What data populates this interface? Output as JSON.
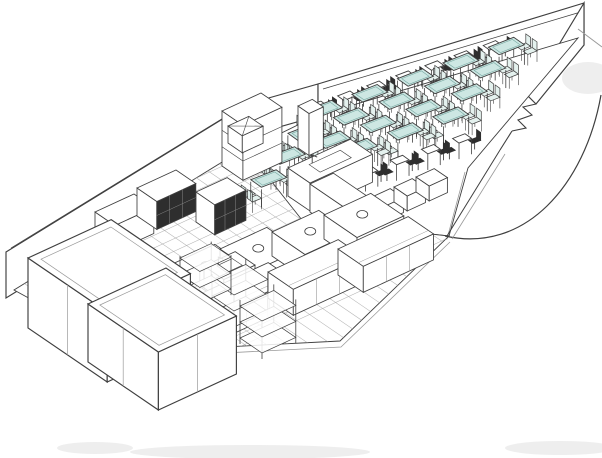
{
  "scene": {
    "canvas": {
      "w": 602,
      "h": 458,
      "bg": "#ffffff"
    },
    "style": {
      "line": "#3f3f3f",
      "lineLight": "#9a9a9a",
      "tile": "#a8a8a8",
      "wallFill": "#ffffff",
      "floorFill": "#ffffff",
      "tableTop": "#cde7e3",
      "tableTopEdge": "#78a8a2",
      "chairFill": "#e4f1ee",
      "darkFurniture": "#2e2e2e",
      "shadow": "#d9d9d9"
    },
    "walls": {
      "kitchenBack": {
        "face": [
          [
            6,
            252
          ],
          [
            247,
            104
          ],
          [
            247,
            150
          ],
          [
            6,
            298
          ]
        ],
        "topEdge": [
          [
            11,
            248
          ],
          [
            251,
            101
          ]
        ]
      },
      "capLine": [
        [
          247,
          104
        ],
        [
          247,
          150
        ]
      ],
      "step": {
        "face": [
          [
            258,
            101
          ],
          [
            318,
            84
          ],
          [
            318,
            116
          ],
          [
            258,
            133
          ]
        ]
      },
      "diningBack": {
        "face": [
          [
            318,
            84
          ],
          [
            584,
            3
          ],
          [
            584,
            45
          ],
          [
            318,
            126
          ]
        ],
        "topEdge": [
          [
            323,
            89
          ],
          [
            584,
            11
          ]
        ]
      },
      "rightUpper": {
        "face": [
          [
            584,
            3
          ],
          [
            584,
            45
          ],
          [
            536,
            104
          ],
          [
            528,
            96
          ]
        ]
      },
      "zigzag": [
        [
          536,
          104
        ],
        [
          523,
          107
        ],
        [
          532,
          115
        ],
        [
          518,
          120
        ],
        [
          526,
          128
        ],
        [
          512,
          131
        ]
      ],
      "doorStub": [
        [
          512,
          131
        ],
        [
          500,
          150
        ]
      ],
      "frontRight1": [
        [
          500,
          150
        ],
        [
          447,
          236
        ]
      ],
      "frontRight2": [
        [
          505,
          154
        ],
        [
          452,
          239
        ]
      ],
      "extTopRight": [
        [
          578,
          29
        ],
        [
          602,
          47
        ]
      ]
    },
    "floors": {
      "dining": [
        [
          316,
          116
        ],
        [
          578,
          38
        ],
        [
          468,
          168
        ],
        [
          449,
          236
        ],
        [
          302,
          221
        ],
        [
          247,
          150
        ]
      ],
      "diningEdgeInner": [
        [
          465,
          172
        ],
        [
          447,
          239
        ],
        [
          300,
          225
        ]
      ],
      "kitchen": [
        [
          245,
          148
        ],
        [
          302,
          220
        ],
        [
          449,
          236
        ],
        [
          340,
          341
        ],
        [
          127,
          352
        ],
        [
          14,
          290
        ]
      ],
      "kitchenBaseLine": [
        [
          127,
          358
        ],
        [
          341,
          347
        ],
        [
          450,
          242
        ]
      ],
      "tilesA": {
        "u": [
          26,
          -12
        ],
        "start": [
          230,
          150
        ],
        "step": [
          11,
          7.5
        ],
        "count": 17,
        "ext": 9.5
      },
      "tilesB": {
        "v": [
          22,
          15
        ],
        "start": [
          2,
          298
        ],
        "step": [
          13,
          -6
        ],
        "count": 36,
        "extNeg": 1.5,
        "extPos": 9
      }
    },
    "arc": {
      "d": "M 445 236 C 525 254, 585 185, 601 95"
    },
    "smudges": [
      {
        "cx": 588,
        "cy": 78,
        "rx": 26,
        "ry": 16
      },
      {
        "cx": 250,
        "cy": 452,
        "rx": 120,
        "ry": 7
      },
      {
        "cx": 560,
        "cy": 448,
        "rx": 55,
        "ry": 7
      },
      {
        "cx": 95,
        "cy": 448,
        "rx": 38,
        "ry": 6
      }
    ],
    "dining": {
      "origin": [
        316,
        116
      ],
      "grid": {
        "u": [
          26,
          -9
        ],
        "v": [
          -16,
          20
        ]
      },
      "item": {
        "u": [
          23,
          -9
        ],
        "v": [
          14,
          10
        ]
      },
      "tableSize": {
        "du": 0.55,
        "dv": 0.38,
        "h": 20
      },
      "chairOffsets": [
        [
          -0.82,
          -0.12
        ],
        [
          -0.82,
          0.34
        ],
        [
          0.82,
          -0.12
        ],
        [
          0.82,
          0.34
        ]
      ],
      "tables": [
        {
          "p": 1.0,
          "q": 1.1
        },
        {
          "p": 2.75,
          "q": 1.1
        },
        {
          "p": 4.5,
          "q": 1.1
        },
        {
          "p": 6.25,
          "q": 1.1
        },
        {
          "p": 8.0,
          "q": 1.1
        },
        {
          "p": 1.0,
          "q": 2.26
        },
        {
          "p": 2.75,
          "q": 2.26
        },
        {
          "p": 4.5,
          "q": 2.26
        },
        {
          "p": 6.25,
          "q": 2.26
        },
        {
          "p": 8.0,
          "q": 2.26
        },
        {
          "p": 1.0,
          "q": 3.42
        },
        {
          "p": 2.75,
          "q": 3.42
        },
        {
          "p": 4.5,
          "q": 3.42
        },
        {
          "p": 6.25,
          "q": 3.42
        },
        {
          "p": 8.0,
          "q": 3.42
        },
        {
          "p": 1.0,
          "q": 4.58
        },
        {
          "p": 2.75,
          "q": 4.58
        },
        {
          "p": 4.5,
          "q": 4.58
        },
        {
          "p": 6.25,
          "q": 4.58
        },
        {
          "p": 8.0,
          "q": 4.58
        }
      ],
      "wallTables": {
        "q": 0.45,
        "pStart": 0.35,
        "pStep": 1.12,
        "count": 7
      },
      "frontTables": {
        "q": 6.15,
        "pStart": 4.6,
        "pStep": 1.2,
        "count": 5
      }
    },
    "kitchen": {
      "basis": {
        "u": [
          26,
          -12
        ],
        "v": [
          22,
          15
        ]
      },
      "equipment": [
        {
          "t": "shelfbox",
          "a": [
            222,
            166
          ],
          "wu": 1.5,
          "wv": 0.95,
          "h": 55
        },
        {
          "t": "xcube",
          "a": [
            228,
            143
          ],
          "wu": 0.8,
          "wv": 0.65,
          "h": 17
        },
        {
          "t": "box",
          "a": [
            298,
            148
          ],
          "wu": 0.55,
          "wv": 0.5,
          "h": 42
        },
        {
          "t": "box",
          "a": [
            95,
            238
          ],
          "wu": 1.5,
          "wv": 0.9,
          "h": 26
        },
        {
          "t": "darkbox",
          "a": [
            137,
            216
          ],
          "wu": 1.5,
          "wv": 0.9,
          "h": 28
        },
        {
          "t": "darkbox",
          "a": [
            196,
            222
          ],
          "wu": 1.2,
          "wv": 0.85,
          "h": 30
        },
        {
          "t": "servL1",
          "a": [
            288,
            196
          ],
          "wu": 2.4,
          "wv": 1.0,
          "h": 28
        },
        {
          "t": "servL2",
          "a": [
            310,
            212
          ],
          "wu": 0.9,
          "wv": 1.9,
          "h": 28
        },
        {
          "t": "box",
          "a": [
            372,
            212
          ],
          "wu": 0.7,
          "wv": 0.6,
          "h": 15
        },
        {
          "t": "box",
          "a": [
            394,
            202
          ],
          "wu": 0.7,
          "wv": 0.6,
          "h": 15
        },
        {
          "t": "box",
          "a": [
            416,
            192
          ],
          "wu": 0.7,
          "wv": 0.6,
          "h": 15
        },
        {
          "t": "range",
          "a": [
            168,
            290
          ],
          "wu": 1.8,
          "wv": 1.5,
          "h": 24
        },
        {
          "t": "range",
          "a": [
            220,
            273
          ],
          "wu": 1.8,
          "wv": 1.5,
          "h": 24
        },
        {
          "t": "range",
          "a": [
            272,
            256
          ],
          "wu": 1.8,
          "wv": 1.5,
          "h": 24
        },
        {
          "t": "range",
          "a": [
            324,
            239
          ],
          "wu": 1.8,
          "wv": 1.5,
          "h": 24
        },
        {
          "t": "sink",
          "a": [
            92,
            286
          ],
          "wu": 1.3,
          "wv": 0.95,
          "h": 22
        },
        {
          "t": "sink",
          "a": [
            204,
            288
          ],
          "wu": 1.2,
          "wv": 0.9,
          "h": 22
        },
        {
          "t": "counter",
          "a": [
            128,
            344
          ],
          "wu": 2.7,
          "wv": 1.15,
          "h": 26
        },
        {
          "t": "counter",
          "a": [
            198,
            321
          ],
          "wu": 2.7,
          "wv": 1.15,
          "h": 26
        },
        {
          "t": "counter",
          "a": [
            268,
            298
          ],
          "wu": 2.7,
          "wv": 1.15,
          "h": 26
        },
        {
          "t": "counter",
          "a": [
            338,
            275
          ],
          "wu": 2.7,
          "wv": 1.15,
          "h": 26
        },
        {
          "t": "rack",
          "a": [
            212,
            318
          ],
          "wu": 1.3,
          "wv": 1.0,
          "h": 44
        },
        {
          "t": "rack",
          "a": [
            240,
            344
          ],
          "wu": 1.3,
          "wv": 1.0,
          "h": 44
        },
        {
          "t": "rack",
          "a": [
            180,
            296
          ],
          "wu": 1.2,
          "wv": 0.9,
          "h": 40
        },
        {
          "t": "walkin",
          "a": [
            28,
            328
          ],
          "wu": 3.2,
          "wv": 3.6,
          "h": 70
        },
        {
          "t": "walkin",
          "a": [
            88,
            362
          ],
          "wu": 3.0,
          "wv": 3.2,
          "h": 58
        }
      ]
    }
  }
}
